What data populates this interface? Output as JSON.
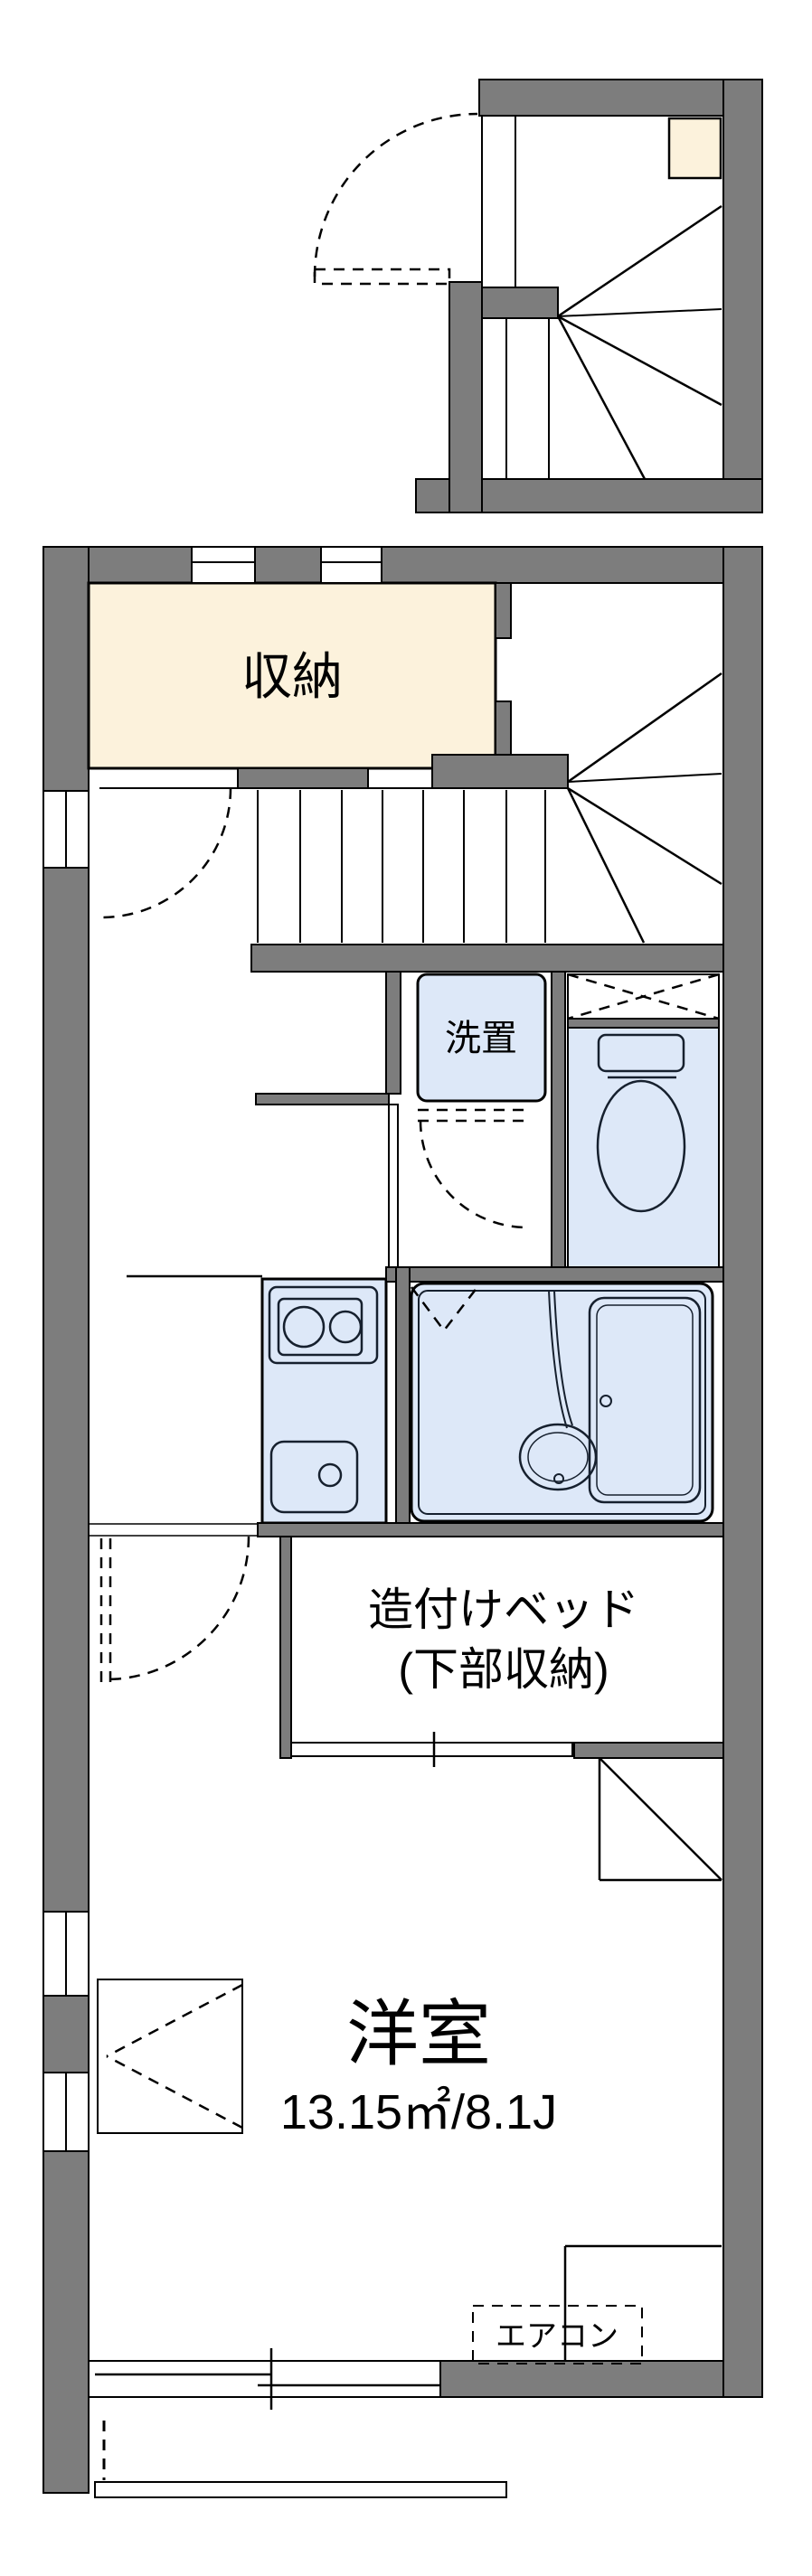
{
  "plan": {
    "kind": "apartment floor plan",
    "labels": {
      "storage": "収納",
      "washer_space": "洗置",
      "bed_line1": "造付けベッド",
      "bed_line2": "(下部収納)",
      "room_name": "洋室",
      "room_area": "13.15㎡/8.1J",
      "aircon": "エアコン"
    },
    "colors": {
      "wall": "#7d7d7d",
      "outline": "#000000",
      "storage_fill": "#fcf2dc",
      "water_fill": "#dde8f8",
      "fixture_line": "#16202e",
      "background": "#ffffff"
    }
  }
}
